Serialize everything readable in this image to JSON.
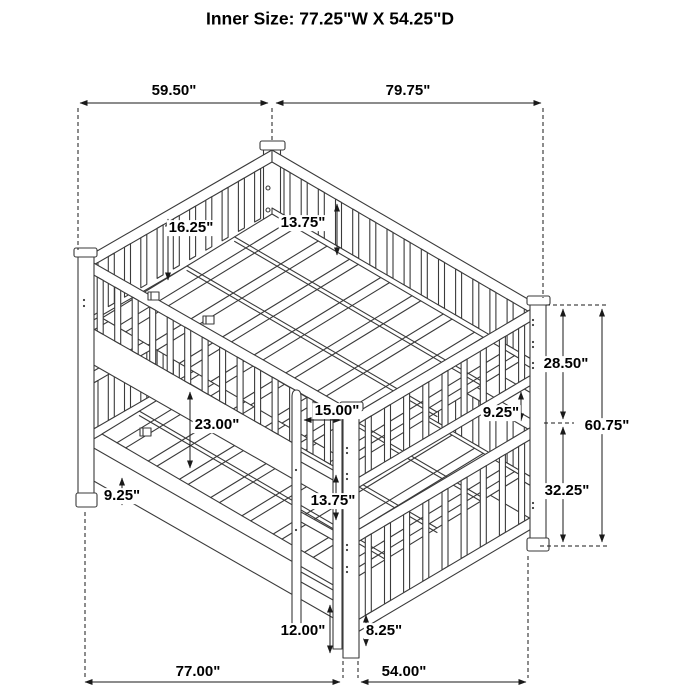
{
  "title": "Inner Size: 77.25\"W X 54.25\"D",
  "dims": {
    "w5950": "59.50\"",
    "w7975": "79.75\"",
    "h1625": "16.25\"",
    "h1375a": "13.75\"",
    "h2850": "28.50\"",
    "h925r": "9.25\"",
    "h6075": "60.75\"",
    "w1500": "15.00\"",
    "h2300": "23.00\"",
    "h925l": "9.25\"",
    "h3225": "32.25\"",
    "h1375b": "13.75\"",
    "h1200": "12.00\"",
    "h825": "8.25\"",
    "w7700": "77.00\"",
    "w5400": "54.00\""
  }
}
